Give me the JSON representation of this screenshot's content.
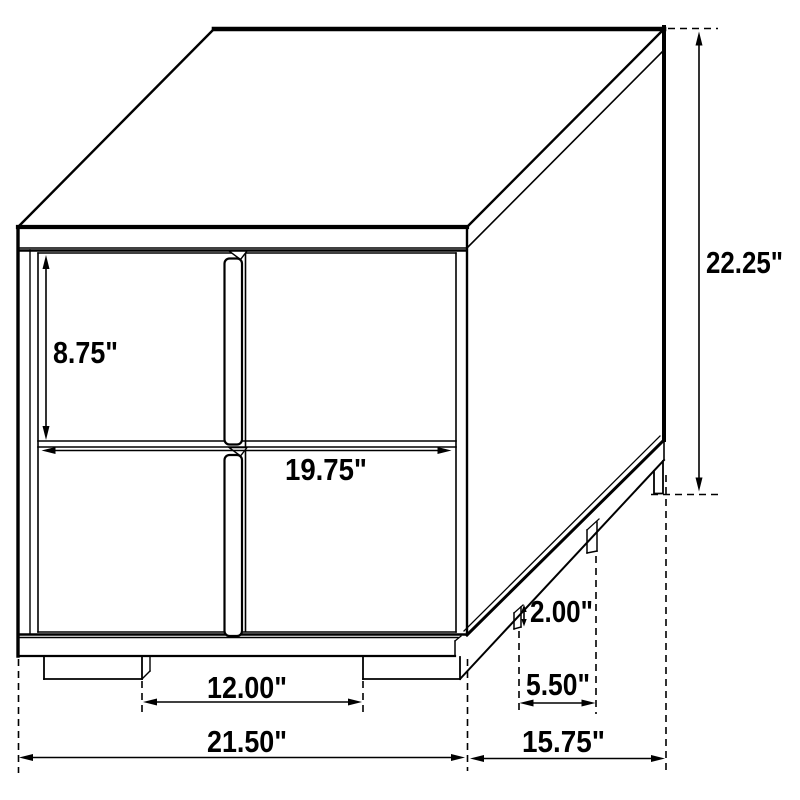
{
  "diagram": {
    "type": "furniture-dimension-drawing",
    "subject": "two-drawer nightstand isometric line drawing",
    "units": "inches",
    "line_color": "#000000",
    "background_color": "#ffffff",
    "dimensions": {
      "overall_height": "22.25\"",
      "drawer_front_height": "8.75\"",
      "drawer_front_width": "19.75\"",
      "leg_height": "2.00\"",
      "front_leg_spacing": "12.00\"",
      "side_leg_spacing": "5.50\"",
      "overall_width": "21.50\"",
      "overall_depth": "15.75\""
    }
  }
}
